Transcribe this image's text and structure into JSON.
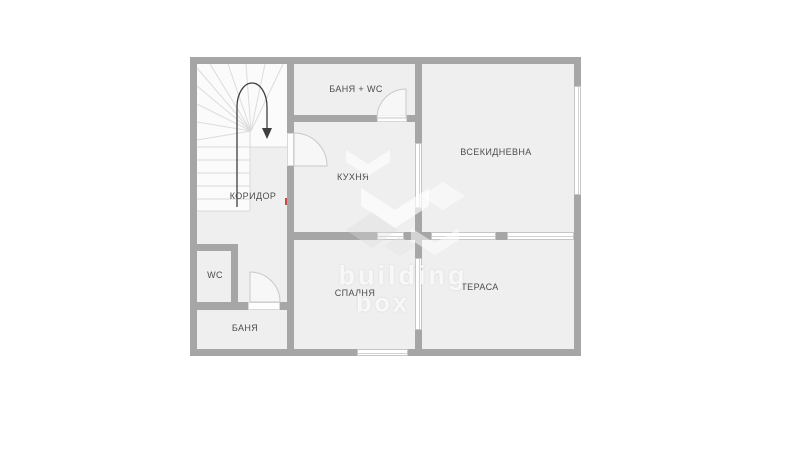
{
  "plan": {
    "title": "floor-plan",
    "rooms": {
      "bath_wc": "БАНЯ + WC",
      "living": "ВСЕКИДНЕВНА",
      "kitchen": "КУХНЯ",
      "corridor": "КОРИДОР",
      "wc": "WC",
      "bath": "БАНЯ",
      "bedroom": "СПАЛНЯ",
      "terrace": "ТЕРАСА"
    },
    "stairs": {
      "direction": "down",
      "type": "u-shaped-winder"
    },
    "watermark": {
      "line1": "building",
      "line2": "box"
    },
    "colors": {
      "wall": "#a6a6a6",
      "floor": "#efefef",
      "stair": "#fbfbfb",
      "label": "#4d4d4d",
      "window_frame": "#c6c6c6",
      "arrow": "#3f3f3f",
      "red_mark": "#cc3333"
    }
  }
}
